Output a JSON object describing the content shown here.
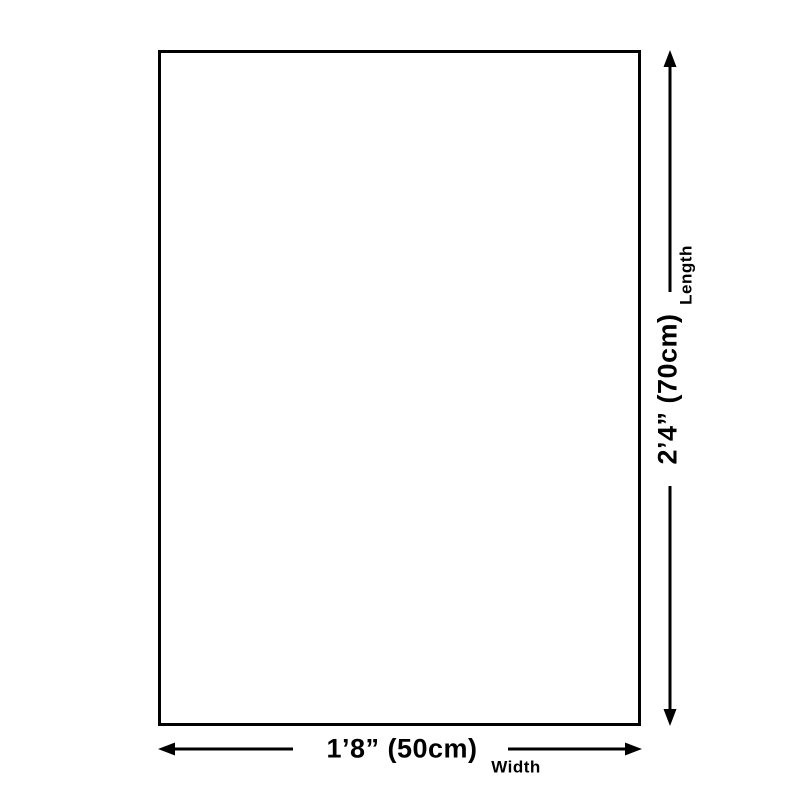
{
  "diagram": {
    "type": "product-dimension-diagram",
    "length": {
      "value": "2’4” (70cm)",
      "label": "Length",
      "orientation": "vertical"
    },
    "width": {
      "value": "1’8” (50cm)",
      "label": "Width",
      "orientation": "horizontal"
    }
  },
  "colors": {
    "line": "#000000",
    "background": "#ffffff"
  }
}
